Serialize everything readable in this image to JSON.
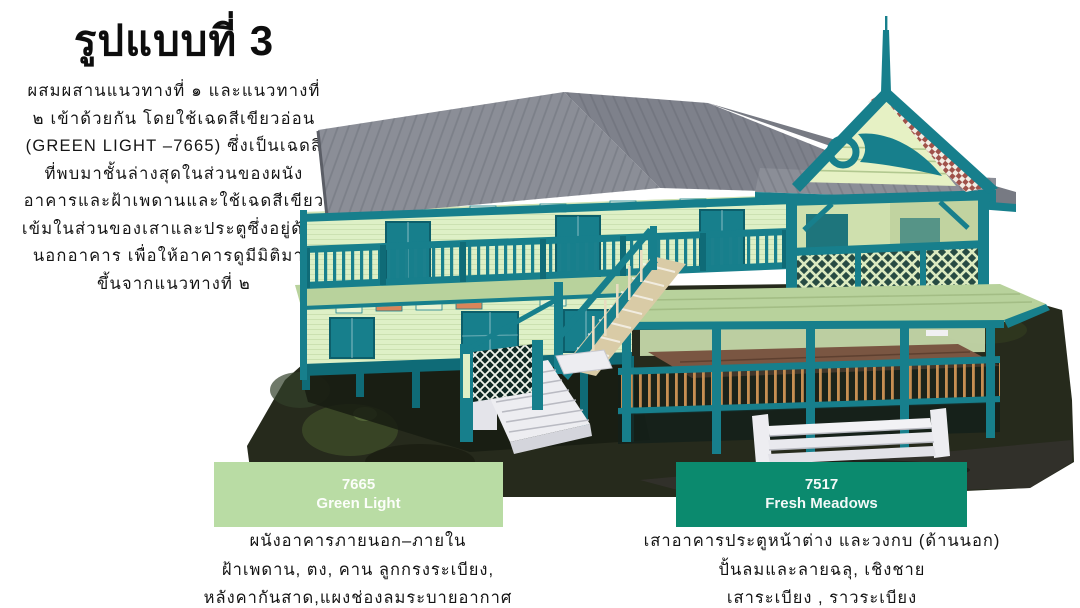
{
  "title": "รูปแบบที่ 3",
  "description": {
    "lines": [
      "ผสมผสานแนวทางที่ ๑ และแนวทางที่",
      "๒ เข้าด้วยกัน โดยใช้เฉดสีเขียวอ่อน",
      "(GREEN LIGHT –7665) ซึ่งเป็นเฉดสี",
      "ที่พบมาชั้นล่างสุดในส่วนของผนัง",
      "อาคารและฝ้าเพดานและใช้เฉดสีเขียว",
      "เข้มในส่วนของเสาและประตูซึ่งอยู่ด้าน",
      "นอกอาคาร เพื่อให้อาคารดูมีมิติมาก",
      "ขึ้นจากแนวทางที่ ๒"
    ]
  },
  "render": {
    "subject": "3D model of a two-storey Thai house, green-light walls with dark green trim"
  },
  "swatches": [
    {
      "code": "7665",
      "name": "Green Light",
      "color": "#b9dca4",
      "caption_lines": [
        "ผนังอาคารภายนอก–ภายใน",
        "ฝ้าเพดาน, ตง, คาน ลูกกรงระเบียง,",
        "หลังคากันสาด,แผงช่องลมระบายอากาศ"
      ]
    },
    {
      "code": "7517",
      "name": "Fresh Meadows",
      "color": "#0b8a6e",
      "caption_lines": [
        "เสาอาคารประตูหน้าต่าง และวงกบ (ด้านนอก)",
        "ปั้นลมและลายฉลุ, เชิงชาย",
        "เสาระเบียง , ราวระเบียง"
      ]
    }
  ],
  "palette": {
    "teal": "#177f8c",
    "teal_dark": "#0f6b77",
    "wall": "#def0c6",
    "wall_shade": "#cde0b0",
    "roof": "#8b8e97",
    "roof_dark": "#7e818b",
    "pale_roof": "#b8d29c",
    "gable": "#e6f1c4",
    "checker_red": "#a0524a",
    "deck": "#7a5642",
    "wood": "#c68e52",
    "terrain": "#262a1c",
    "step_white": "#ededf1",
    "swatch_green_light": "#b9dca4",
    "swatch_fresh_meadows": "#0b8a6e"
  }
}
